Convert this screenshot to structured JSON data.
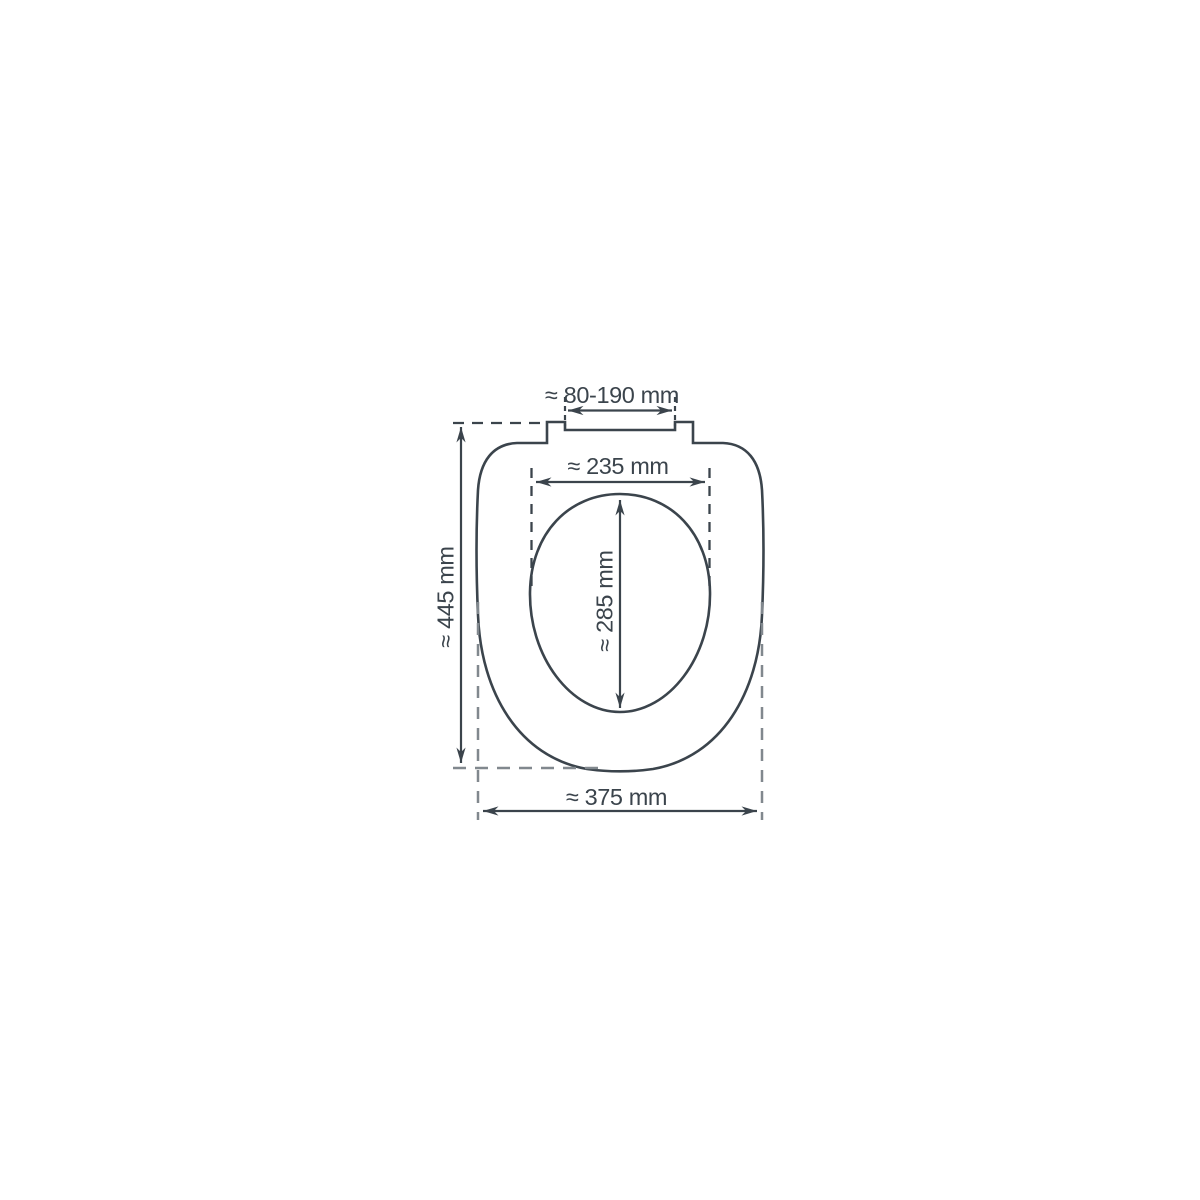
{
  "diagram": {
    "type": "technical-dimension-drawing",
    "subject": "toilet-seat-top-view",
    "unit": "mm",
    "colors": {
      "line_color": "#3b444c",
      "dashed_guide_color": "#81888e",
      "background": "#ffffff"
    },
    "dimensions": {
      "hinge_spacing": {
        "label": "≈ 80-190 mm"
      },
      "inner_width": {
        "label": "≈ 235 mm"
      },
      "inner_length": {
        "label": "≈ 285 mm"
      },
      "outer_length": {
        "label": "≈ 445 mm"
      },
      "outer_width": {
        "label": "≈ 375 mm"
      }
    }
  }
}
